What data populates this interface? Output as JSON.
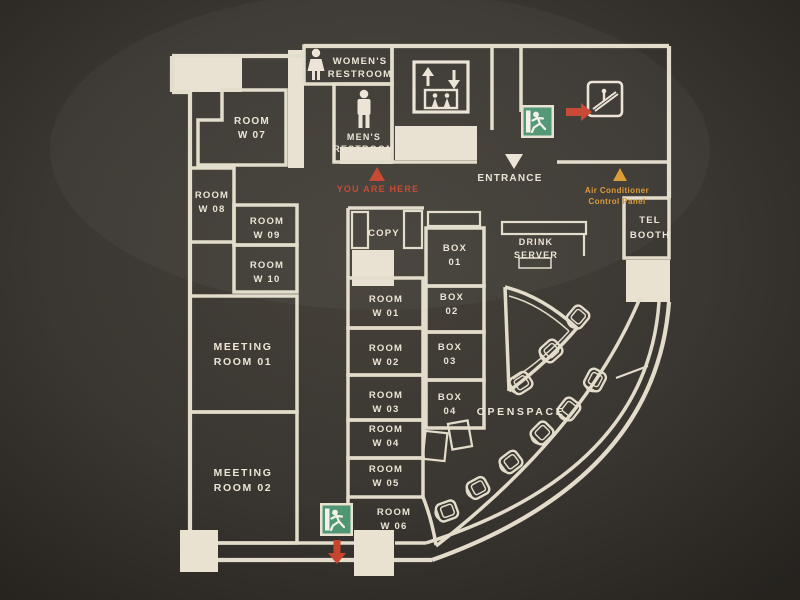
{
  "title": "office-floor-guide-map",
  "colors": {
    "background": "#3a3631",
    "wall": "#e3dcca",
    "text": "#ece5d6",
    "accent_red": "#c7452e",
    "accent_orange": "#dc9a33",
    "exit_green": "#4e9674",
    "pillar": "#e9e2d1"
  },
  "restrooms": {
    "women": [
      "WOMEN'S",
      "RESTROOM"
    ],
    "men": [
      "MEN'S",
      "RESTROOM"
    ]
  },
  "markers": {
    "you_are_here": "YOU ARE HERE",
    "entrance": "ENTRANCE",
    "air_conditioner": [
      "Air Conditioner",
      "Control Panel"
    ]
  },
  "rooms": {
    "w01": [
      "ROOM",
      "W 01"
    ],
    "w02": [
      "ROOM",
      "W 02"
    ],
    "w03": [
      "ROOM",
      "W 03"
    ],
    "w04": [
      "ROOM",
      "W 04"
    ],
    "w05": [
      "ROOM",
      "W 05"
    ],
    "w06": [
      "ROOM",
      "W 06"
    ],
    "w07": [
      "ROOM",
      "W 07"
    ],
    "w08": [
      "ROOM",
      "W 08"
    ],
    "w09": [
      "ROOM",
      "W 09"
    ],
    "w10": [
      "ROOM",
      "W 10"
    ],
    "meeting_01": [
      "MEETING",
      "ROOM 01"
    ],
    "meeting_02": [
      "MEETING",
      "ROOM 02"
    ]
  },
  "boxes": {
    "b01": [
      "BOX",
      "01"
    ],
    "b02": [
      "BOX",
      "02"
    ],
    "b03": [
      "BOX",
      "03"
    ],
    "b04": [
      "BOX",
      "04"
    ]
  },
  "areas": {
    "copy": "COPY",
    "drink_server": [
      "DRINK",
      "SERVER"
    ],
    "openspace": "OPENSPACE",
    "tel_booth": [
      "TEL",
      "BOOTH"
    ]
  },
  "icons": {
    "woman-icon": "woman pictogram",
    "man-icon": "man pictogram",
    "elevator-icon": "up/down arrows with passengers",
    "escalator-icon": "person on escalator",
    "exit-icon": "green running-man exit sign",
    "you-are-here-icon": "red triangle up",
    "entrance-icon": "white triangle down",
    "aircon-icon": "orange triangle up",
    "arrow-right-icon": "red arrow right",
    "arrow-down-icon": "red arrow down",
    "chair-icon": "chair outline"
  },
  "openspace_chair_count": 9
}
